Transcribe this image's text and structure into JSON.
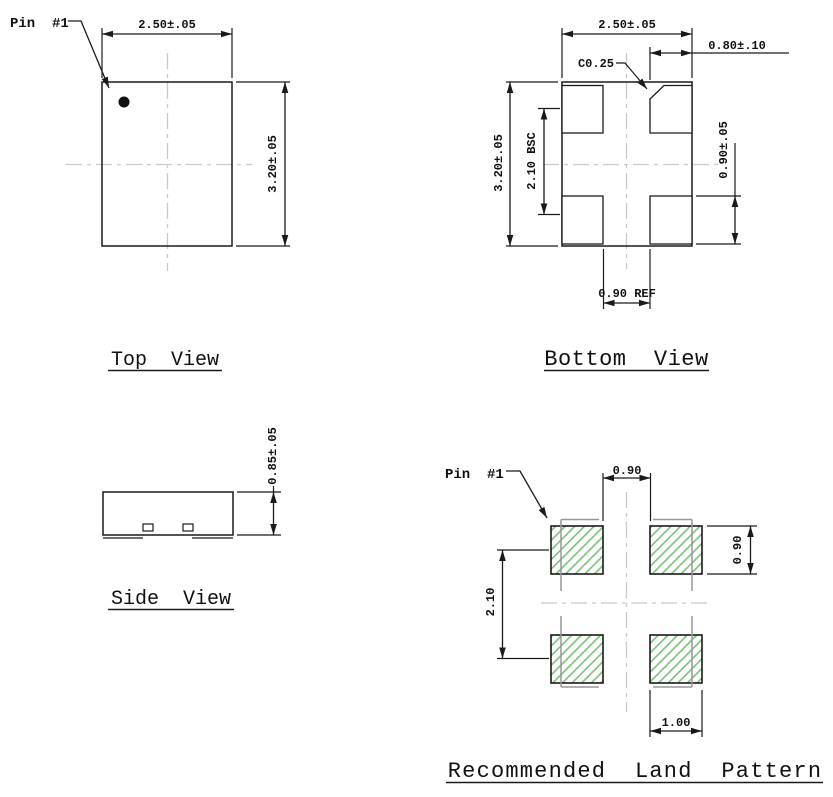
{
  "top_view": {
    "title": "Top  View",
    "pin_label": "Pin  #1",
    "dim_width": "2.50±.05",
    "dim_height": "3.20±.05"
  },
  "bottom_view": {
    "title": "Bottom  View",
    "dim_width": "2.50±.05",
    "dim_height": "3.20±.05",
    "dim_pad_pitch": "2.10 BSC",
    "dim_pad_width": "0.80±.10",
    "dim_pad_height": "0.90±.05",
    "dim_chamfer": "C0.25",
    "dim_pad_gap": "0.90 REF"
  },
  "side_view": {
    "title": "Side  View",
    "dim_height": "0.85±.05"
  },
  "land_pattern": {
    "title": "Recommended  Land  Pattern",
    "pin_label": "Pin  #1",
    "dim_pad_gap_x": "0.90",
    "dim_pad_height": "0.90",
    "dim_pad_pitch_y": "2.10",
    "dim_pad_width": "1.00"
  },
  "colors": {
    "line": "#1a1a1a",
    "centerline": "#c9c9c9",
    "package_outline_gray": "#979797",
    "land_pad_hatch_green": "#6cbf6c"
  }
}
